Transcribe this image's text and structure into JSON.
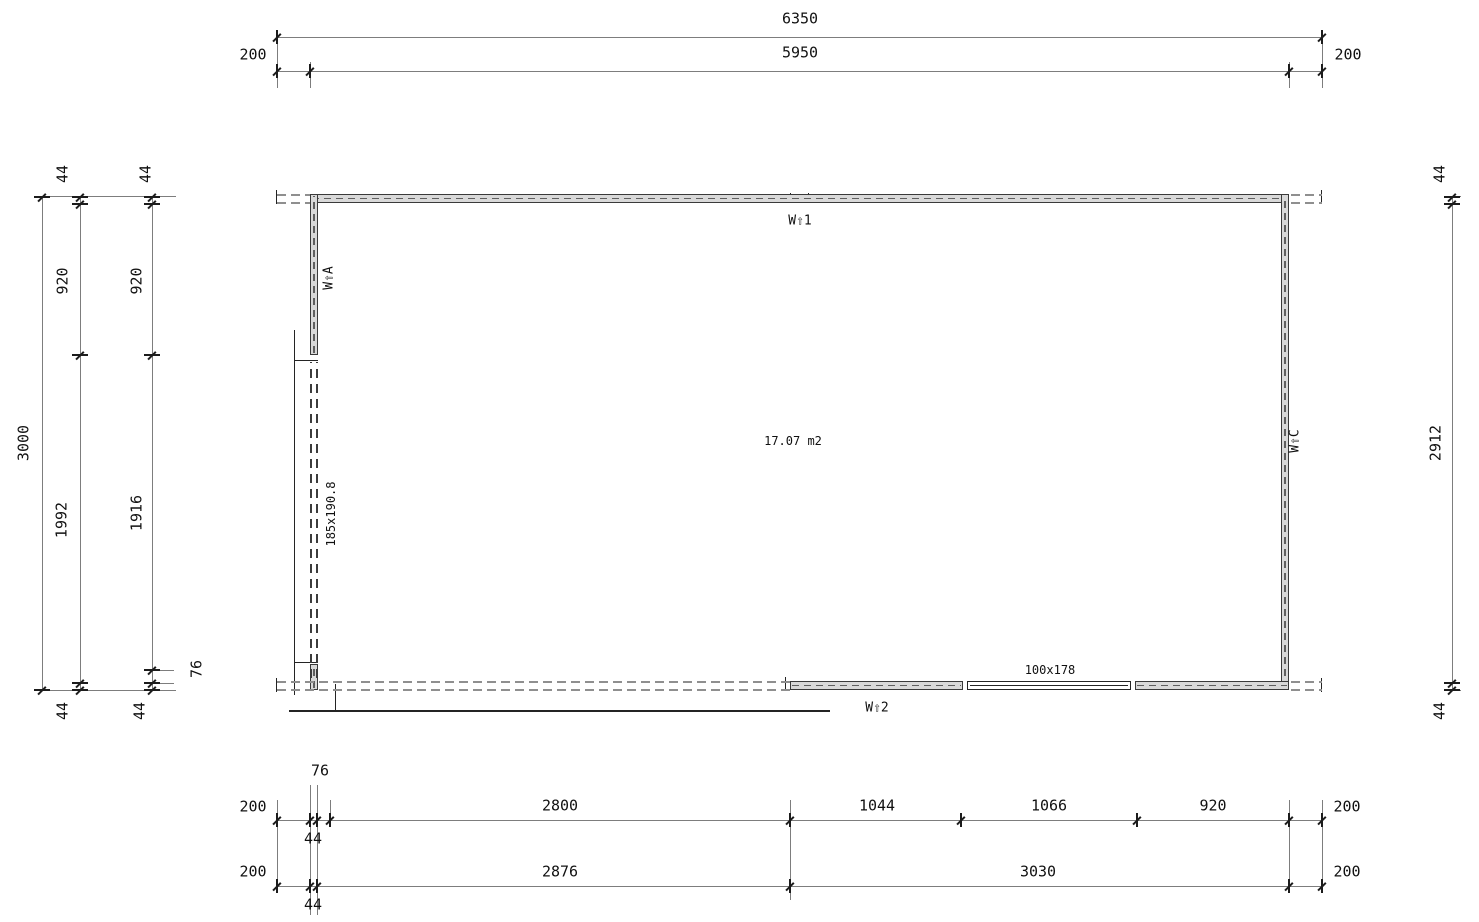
{
  "drawing": {
    "area_label": "17.07 m2",
    "door_size_label": "185x190.8",
    "window_size_label": "100x178",
    "wall_markers": {
      "w1": "W⇧1",
      "w2": "W⇧2",
      "wa": "W⇧A",
      "wc": "W⇧C"
    },
    "labels": [
      {
        "name": "dim-top-overall-6350",
        "text": "6350",
        "x": 800,
        "y": 19,
        "rot": 0
      },
      {
        "name": "dim-top-wall-5950",
        "text": "5950",
        "x": 800,
        "y": 53,
        "rot": 0
      },
      {
        "name": "dim-top-overhang-left-200",
        "text": "200",
        "x": 253,
        "y": 55,
        "rot": 0
      },
      {
        "name": "dim-top-overhang-right-200",
        "text": "200",
        "x": 1348,
        "y": 55,
        "rot": 0
      },
      {
        "name": "dim-left-total-3000",
        "text": "3000",
        "x": 24,
        "y": 443,
        "rot": -90
      },
      {
        "name": "dim-left-44-top-a",
        "text": "44",
        "x": 63,
        "y": 174,
        "rot": -90
      },
      {
        "name": "dim-left-920-a",
        "text": "920",
        "x": 63,
        "y": 281,
        "rot": -90
      },
      {
        "name": "dim-left-1992",
        "text": "1992",
        "x": 62,
        "y": 520,
        "rot": -90
      },
      {
        "name": "dim-left-44-bottom-a",
        "text": "44",
        "x": 63,
        "y": 711,
        "rot": -90
      },
      {
        "name": "dim-left-44-top-b",
        "text": "44",
        "x": 146,
        "y": 174,
        "rot": -90
      },
      {
        "name": "dim-left-920-b",
        "text": "920",
        "x": 137,
        "y": 281,
        "rot": -90
      },
      {
        "name": "dim-left-1916",
        "text": "1916",
        "x": 137,
        "y": 513,
        "rot": -90
      },
      {
        "name": "dim-left-76",
        "text": "76",
        "x": 197,
        "y": 669,
        "rot": -90
      },
      {
        "name": "dim-left-44-bottom-b",
        "text": "44",
        "x": 140,
        "y": 711,
        "rot": -90
      },
      {
        "name": "dim-right-44-top",
        "text": "44",
        "x": 1440,
        "y": 174,
        "rot": -90
      },
      {
        "name": "dim-right-2912",
        "text": "2912",
        "x": 1436,
        "y": 443,
        "rot": -90
      },
      {
        "name": "dim-right-44-bottom",
        "text": "44",
        "x": 1440,
        "y": 711,
        "rot": -90
      },
      {
        "name": "dim-bottom-76",
        "text": "76",
        "x": 320,
        "y": 771,
        "rot": 0
      },
      {
        "name": "dim-bottom1-200-left",
        "text": "200",
        "x": 253,
        "y": 807,
        "rot": 0
      },
      {
        "name": "dim-bottom1-2800",
        "text": "2800",
        "x": 560,
        "y": 806,
        "rot": 0
      },
      {
        "name": "dim-bottom1-1044",
        "text": "1044",
        "x": 877,
        "y": 806,
        "rot": 0
      },
      {
        "name": "dim-bottom1-1066",
        "text": "1066",
        "x": 1049,
        "y": 806,
        "rot": 0
      },
      {
        "name": "dim-bottom1-920",
        "text": "920",
        "x": 1213,
        "y": 806,
        "rot": 0
      },
      {
        "name": "dim-bottom1-200-right",
        "text": "200",
        "x": 1347,
        "y": 807,
        "rot": 0
      },
      {
        "name": "dim-bottom1-44",
        "text": "44",
        "x": 313,
        "y": 839,
        "rot": 0
      },
      {
        "name": "dim-bottom2-200-left",
        "text": "200",
        "x": 253,
        "y": 872,
        "rot": 0
      },
      {
        "name": "dim-bottom2-2876",
        "text": "2876",
        "x": 560,
        "y": 872,
        "rot": 0
      },
      {
        "name": "dim-bottom2-3030",
        "text": "3030",
        "x": 1038,
        "y": 872,
        "rot": 0
      },
      {
        "name": "dim-bottom2-200-right",
        "text": "200",
        "x": 1347,
        "y": 872,
        "rot": 0
      },
      {
        "name": "dim-bottom2-44",
        "text": "44",
        "x": 313,
        "y": 905,
        "rot": 0
      },
      {
        "name": "door-size-label",
        "text": "185x190.8",
        "x": 331,
        "y": 514,
        "rot": -90,
        "small": true
      },
      {
        "name": "window-size-label",
        "text": "100x178",
        "x": 1050,
        "y": 670,
        "rot": 0,
        "small": true
      },
      {
        "name": "room-area-label",
        "text": "17.07 m2",
        "x": 793,
        "y": 441,
        "rot": 0,
        "small": true
      },
      {
        "name": "wall-marker-w1",
        "text": "W⇧1",
        "x": 800,
        "y": 221,
        "rot": 0,
        "marker": true
      },
      {
        "name": "wall-marker-w2",
        "text": "W⇧2",
        "x": 877,
        "y": 708,
        "rot": 0,
        "marker": true
      },
      {
        "name": "wall-marker-wa",
        "text": "W⇧A",
        "x": 329,
        "y": 278,
        "rot": -90,
        "marker": true
      },
      {
        "name": "wall-marker-wc",
        "text": "W⇧C",
        "x": 1295,
        "y": 441,
        "rot": -90,
        "marker": true
      }
    ]
  }
}
